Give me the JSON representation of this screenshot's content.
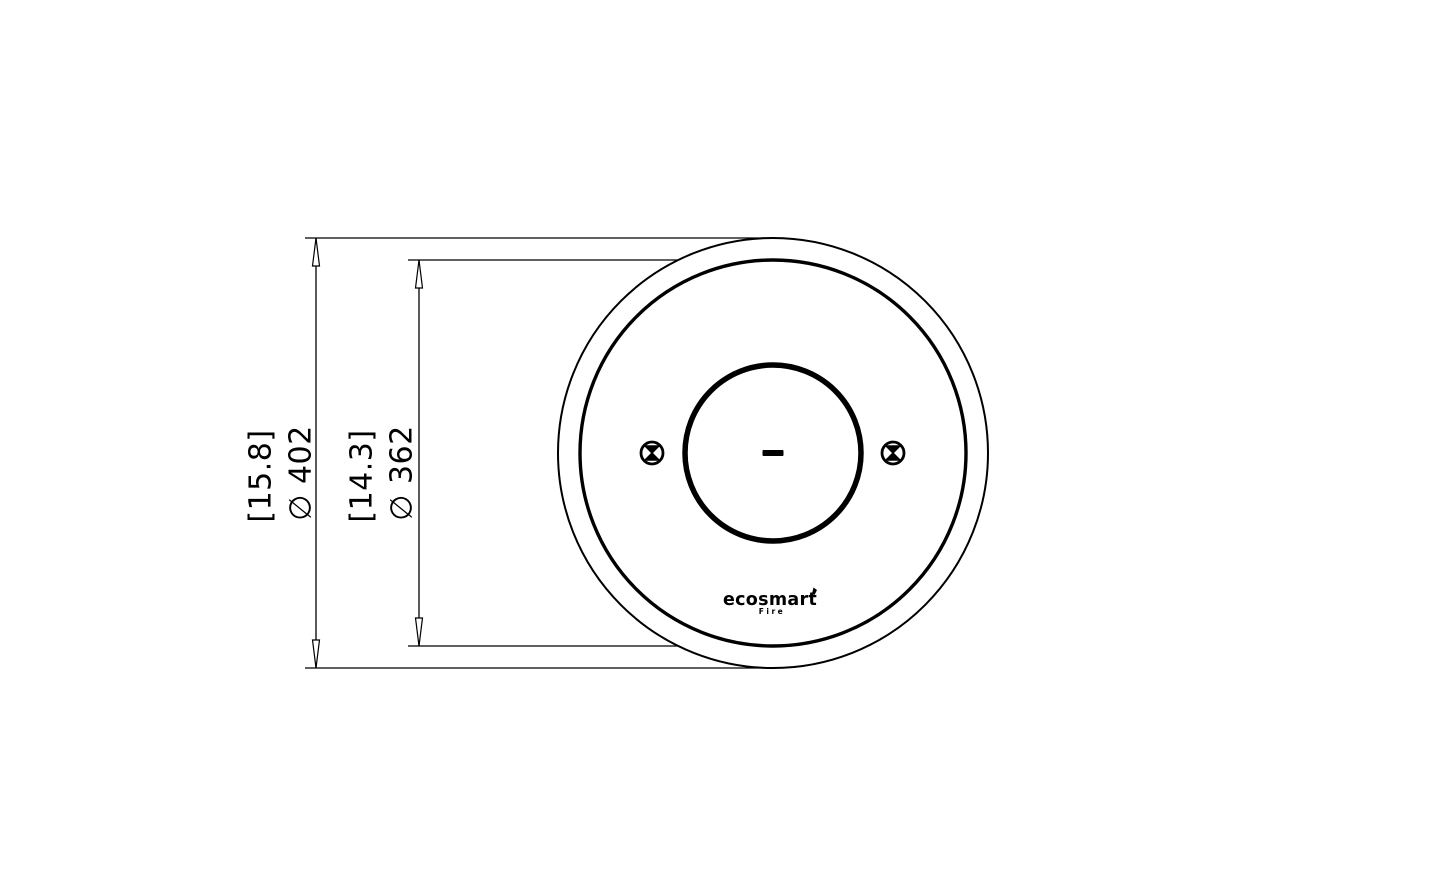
{
  "page": {
    "background": "#ffffff",
    "ink": "#000000",
    "description": "Technical dimension drawing, top view of a round fire pit burner"
  },
  "drawing": {
    "labels": {
      "outer": {
        "bracket": "[15.8]",
        "diameter": "∅ 402"
      },
      "inner": {
        "bracket": "[14.3]",
        "diameter": "∅ 362"
      }
    },
    "logo": {
      "brand": "ecosmart",
      "sub": "Fire"
    }
  }
}
